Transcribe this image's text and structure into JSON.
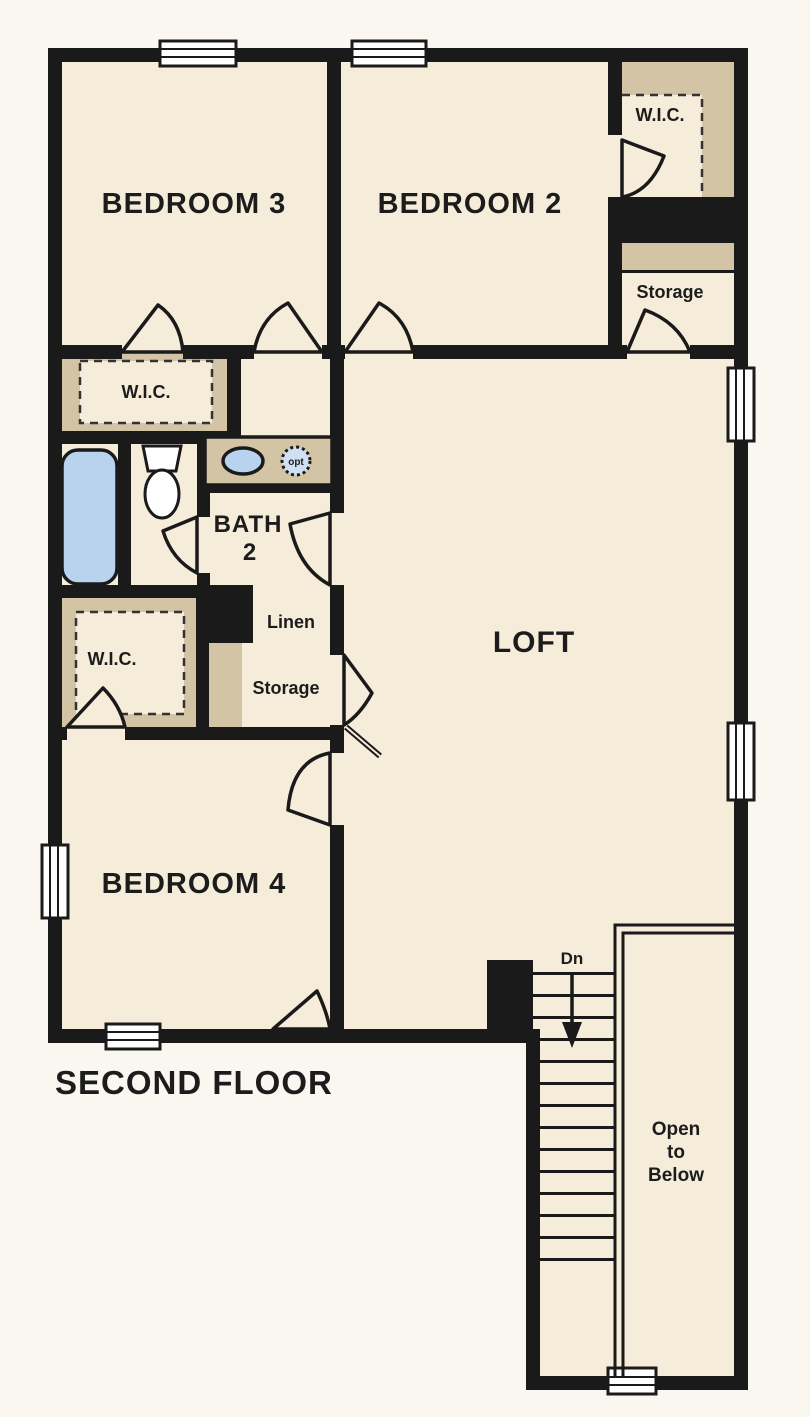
{
  "plan": {
    "title": "SECOND FLOOR",
    "rooms": {
      "bedroom3": "BEDROOM 3",
      "bedroom2": "BEDROOM 2",
      "bedroom4": "BEDROOM 4",
      "loft": "LOFT",
      "bath_line1": "BATH",
      "bath_line2": "2",
      "wic_top_right": "W.I.C.",
      "wic_mid_left": "W.I.C.",
      "wic_lower_left": "W.I.C.",
      "storage_top_right": "Storage",
      "storage_middle": "Storage",
      "linen": "Linen"
    },
    "stairs": {
      "down_label": "Dn"
    },
    "open_to_below": {
      "line1": "Open",
      "line2": "to",
      "line3": "Below"
    },
    "fixtures": {
      "optional_sink_label": "opt"
    },
    "colors": {
      "background": "#faf7f0",
      "floor": "#f6ecda",
      "closet_tan": "#d3c4a5",
      "wall": "#1a1a1a",
      "fixture_blue": "#b9d3ee"
    }
  }
}
